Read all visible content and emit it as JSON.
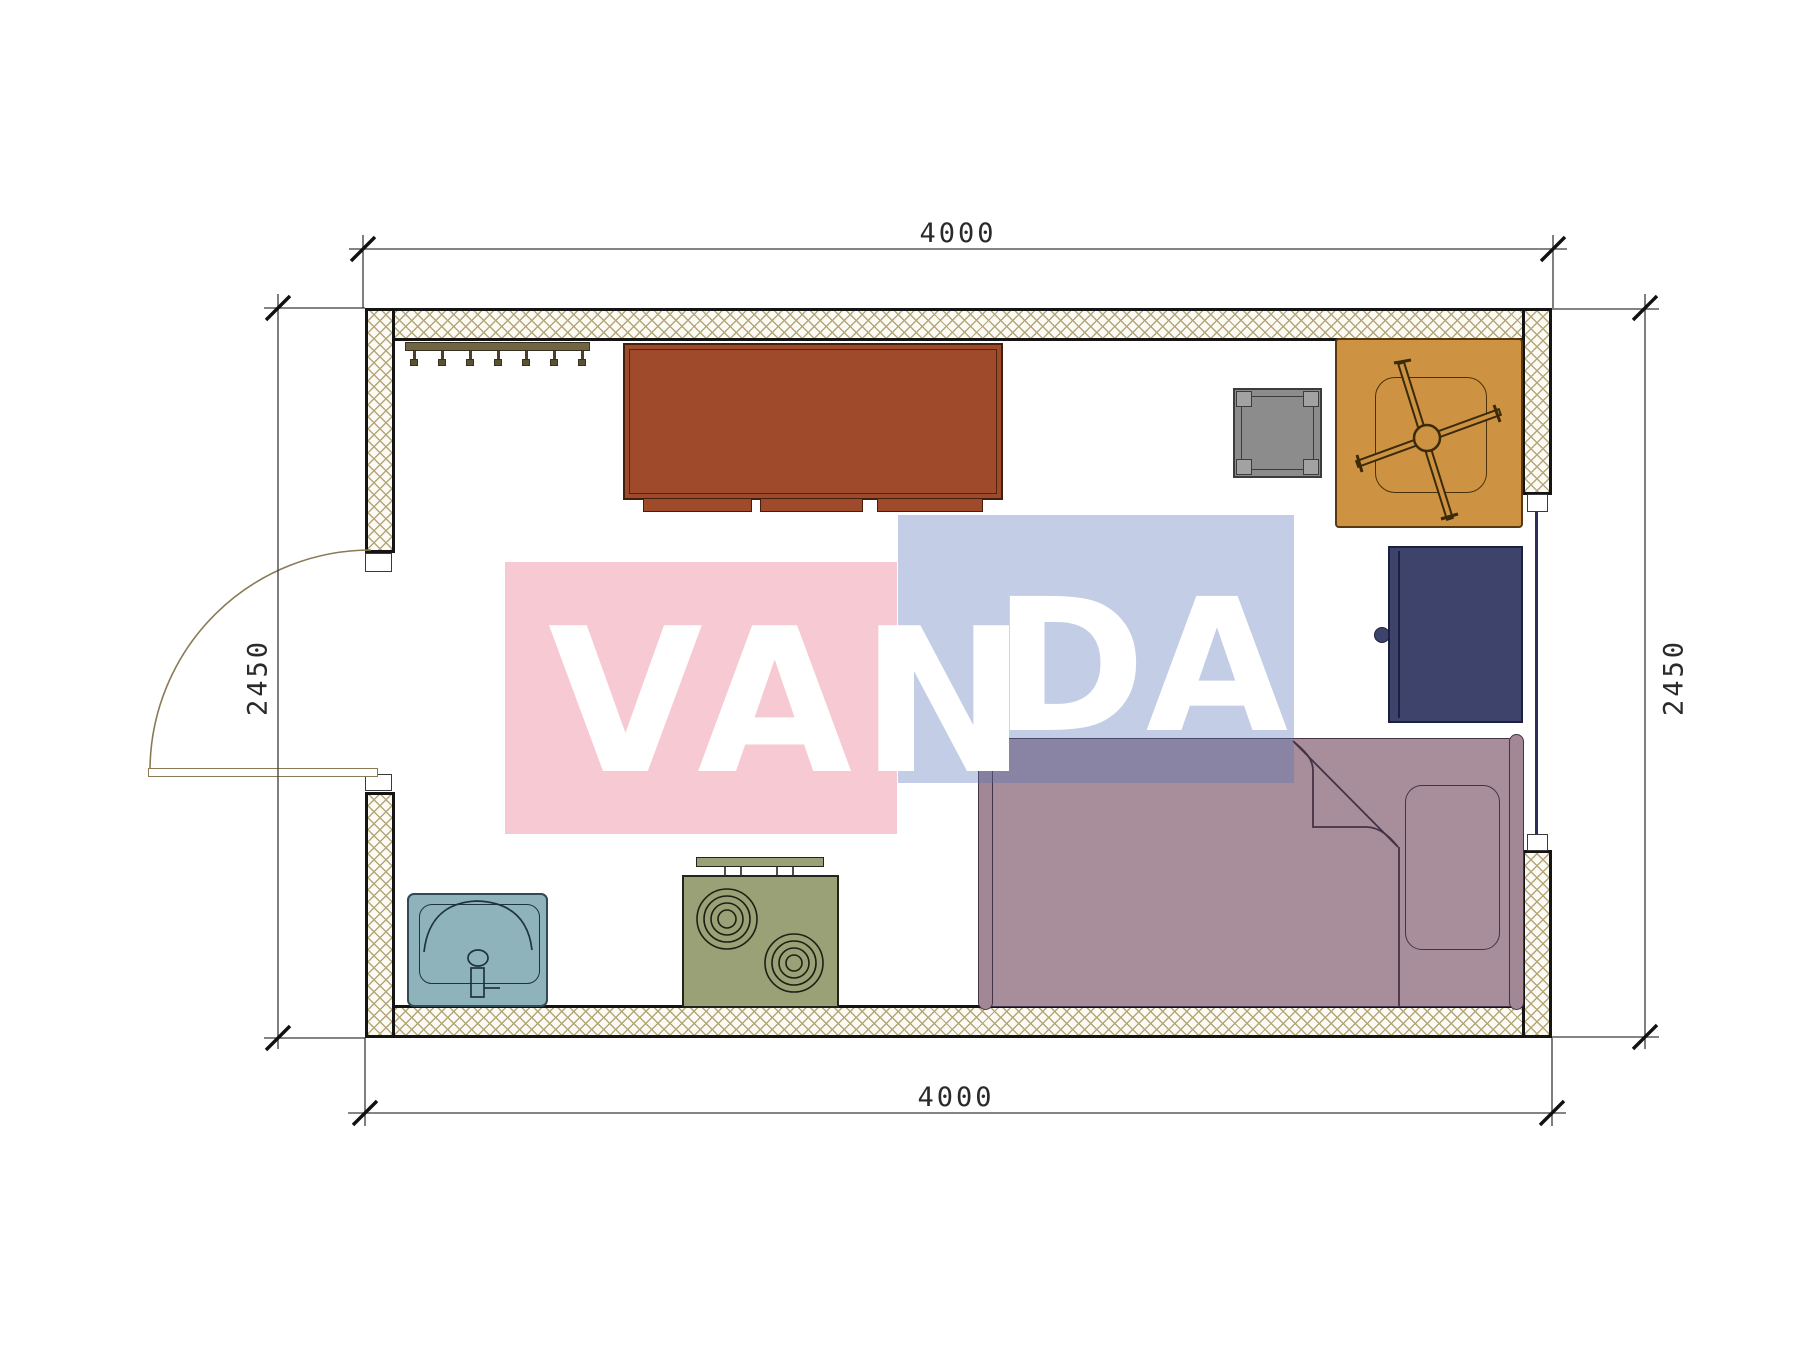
{
  "drawing": {
    "type": "architectural floor plan",
    "room": {
      "width_mm": "4000",
      "depth_mm": "2450"
    },
    "dimensions": {
      "top_label": "4000",
      "bottom_label": "4000",
      "left_label": "2450",
      "right_label": "2450"
    },
    "watermark": {
      "text": "VANDA",
      "part1": "VAN",
      "part2": "DA",
      "pink_color": "#ee879b",
      "blue_color": "#5274b7",
      "text_color": "#ffffff"
    },
    "furniture": [
      {
        "name": "coat-rack",
        "color": "#6f6544"
      },
      {
        "name": "desk",
        "color": "#9e4a2b"
      },
      {
        "name": "stool-table",
        "color": "#8c8c8c"
      },
      {
        "name": "armchair",
        "color": "#cd9342"
      },
      {
        "name": "wardrobe",
        "color": "#3d436b"
      },
      {
        "name": "bed",
        "color": "#a88e9a"
      },
      {
        "name": "sink",
        "color": "#8fb3ba"
      },
      {
        "name": "stove",
        "color": "#9aa177"
      }
    ],
    "openings": [
      {
        "name": "door",
        "wall": "left",
        "swing": "outward"
      },
      {
        "name": "window",
        "wall": "right"
      }
    ],
    "wall_hatch_color": "#b5a678"
  }
}
